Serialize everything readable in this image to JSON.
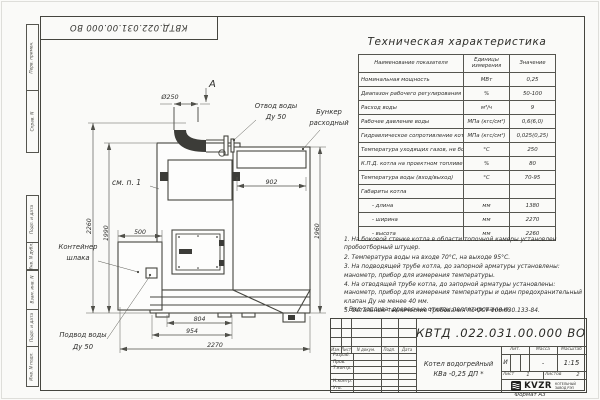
{
  "frame": {
    "doc_number_rotated": "КВТД.022.031.00.000 ВО",
    "side_labels": [
      "Перв. примен.",
      "Справ. N",
      "Подп. и дата",
      "Инв. N дубл.",
      "Взам. инв. N",
      "Подп. и дата",
      "Инв. N подл."
    ],
    "format_note": "Формат А3"
  },
  "table": {
    "title": "Техническая характеристика",
    "headers": [
      "Наименование показателя",
      "Единицы измерения",
      "Значение"
    ],
    "rows": [
      {
        "name": "Номинальная мощность",
        "unit": "МВт",
        "value": "0,25"
      },
      {
        "name": "Диапазон рабочего регулирования",
        "unit": "%",
        "value": "50-100"
      },
      {
        "name": "Расход воды",
        "unit": "м³/ч",
        "value": "9"
      },
      {
        "name": "Рабочее давление воды",
        "unit": "МПа (кгс/см²)",
        "value": "0,6(6,0)"
      },
      {
        "name": "Гидравлическое сопротивление котла",
        "unit": "МПа (кгс/см²)",
        "value": "0,025(0,25)"
      },
      {
        "name": "Температура уходящих газов, не более",
        "unit": "°С",
        "value": "250"
      },
      {
        "name": "К.П.Д. котла на проектном топливе",
        "unit": "%",
        "value": "80"
      },
      {
        "name": "Температура воды (вход/выход)",
        "unit": "°С",
        "value": "70-95"
      },
      {
        "name": "Габариты котла",
        "unit": "",
        "value": ""
      },
      {
        "name": "- длина",
        "unit": "мм",
        "value": "1380",
        "indent": true
      },
      {
        "name": "- ширина",
        "unit": "мм",
        "value": "2270",
        "indent": true
      },
      {
        "name": "- высота",
        "unit": "мм",
        "value": "2260",
        "indent": true
      }
    ]
  },
  "notes": [
    "1. На боковой стенке котла в области топочной камеры установлен пробоотборный штуцер.",
    "2. Температура воды на входе 70°С, на выходе 95°С.",
    "3. На подводящей трубе котла, до запорной арматуры установлены: манометр, прибор для измерения температуры.",
    "4. На отводящей трубе котла, до запорной арматуры установлены: манометр, прибор для измерения температуры и один предохранительный клапан Ду не менее 40 мм.",
    "5. Остальные технические требования по ОСТ 108.030.133-84."
  ],
  "fuel_note": "* Вид топлива: древесные отходы пеллетированные.",
  "drawing": {
    "labels": {
      "view": "А",
      "chimney_dia": "Ø250",
      "outlet_line1": "Отвод воды",
      "outlet_line2": "Ду 50",
      "bunker_line1": "Бункер",
      "bunker_line2": "расходный",
      "see_note": "см. п. 1",
      "slag_line1": "Контейнер",
      "slag_line2": "шлака",
      "inlet_line1": "Подвод воды",
      "inlet_line2": "Ду 50"
    },
    "dims": {
      "d902": "902",
      "d1960": "1960",
      "d2260": "2260",
      "d1990": "1990",
      "d500": "500",
      "d804": "804",
      "d954": "954",
      "d2270": "2270"
    }
  },
  "title_block": {
    "doc_number": "КВТД .022.031.00.000 ВО",
    "name_line1": "Котел водогрейный",
    "name_line2": "КВа -0,25 ДП *",
    "lit_label": "Лит.",
    "lit_value": "И",
    "mass_label": "Масса",
    "mass_value": "-",
    "scale_label": "Масштаб",
    "scale_value": "1:15",
    "sheet_label": "Лист",
    "sheet_value": "1",
    "sheets_label": "Листов",
    "sheets_value": "2",
    "change_cols": [
      "Изм.",
      "Лист",
      "N докум.",
      "Подп.",
      "Дата"
    ],
    "sign_rows": [
      "Разраб.",
      "Пров.",
      "Т.контр.",
      "",
      "Н.контр.",
      "Утв."
    ],
    "logo_text": "KVZR",
    "logo_sub1": "КОТЕЛЬНЫЙ",
    "logo_sub2": "ЗАВОД РЭП"
  }
}
